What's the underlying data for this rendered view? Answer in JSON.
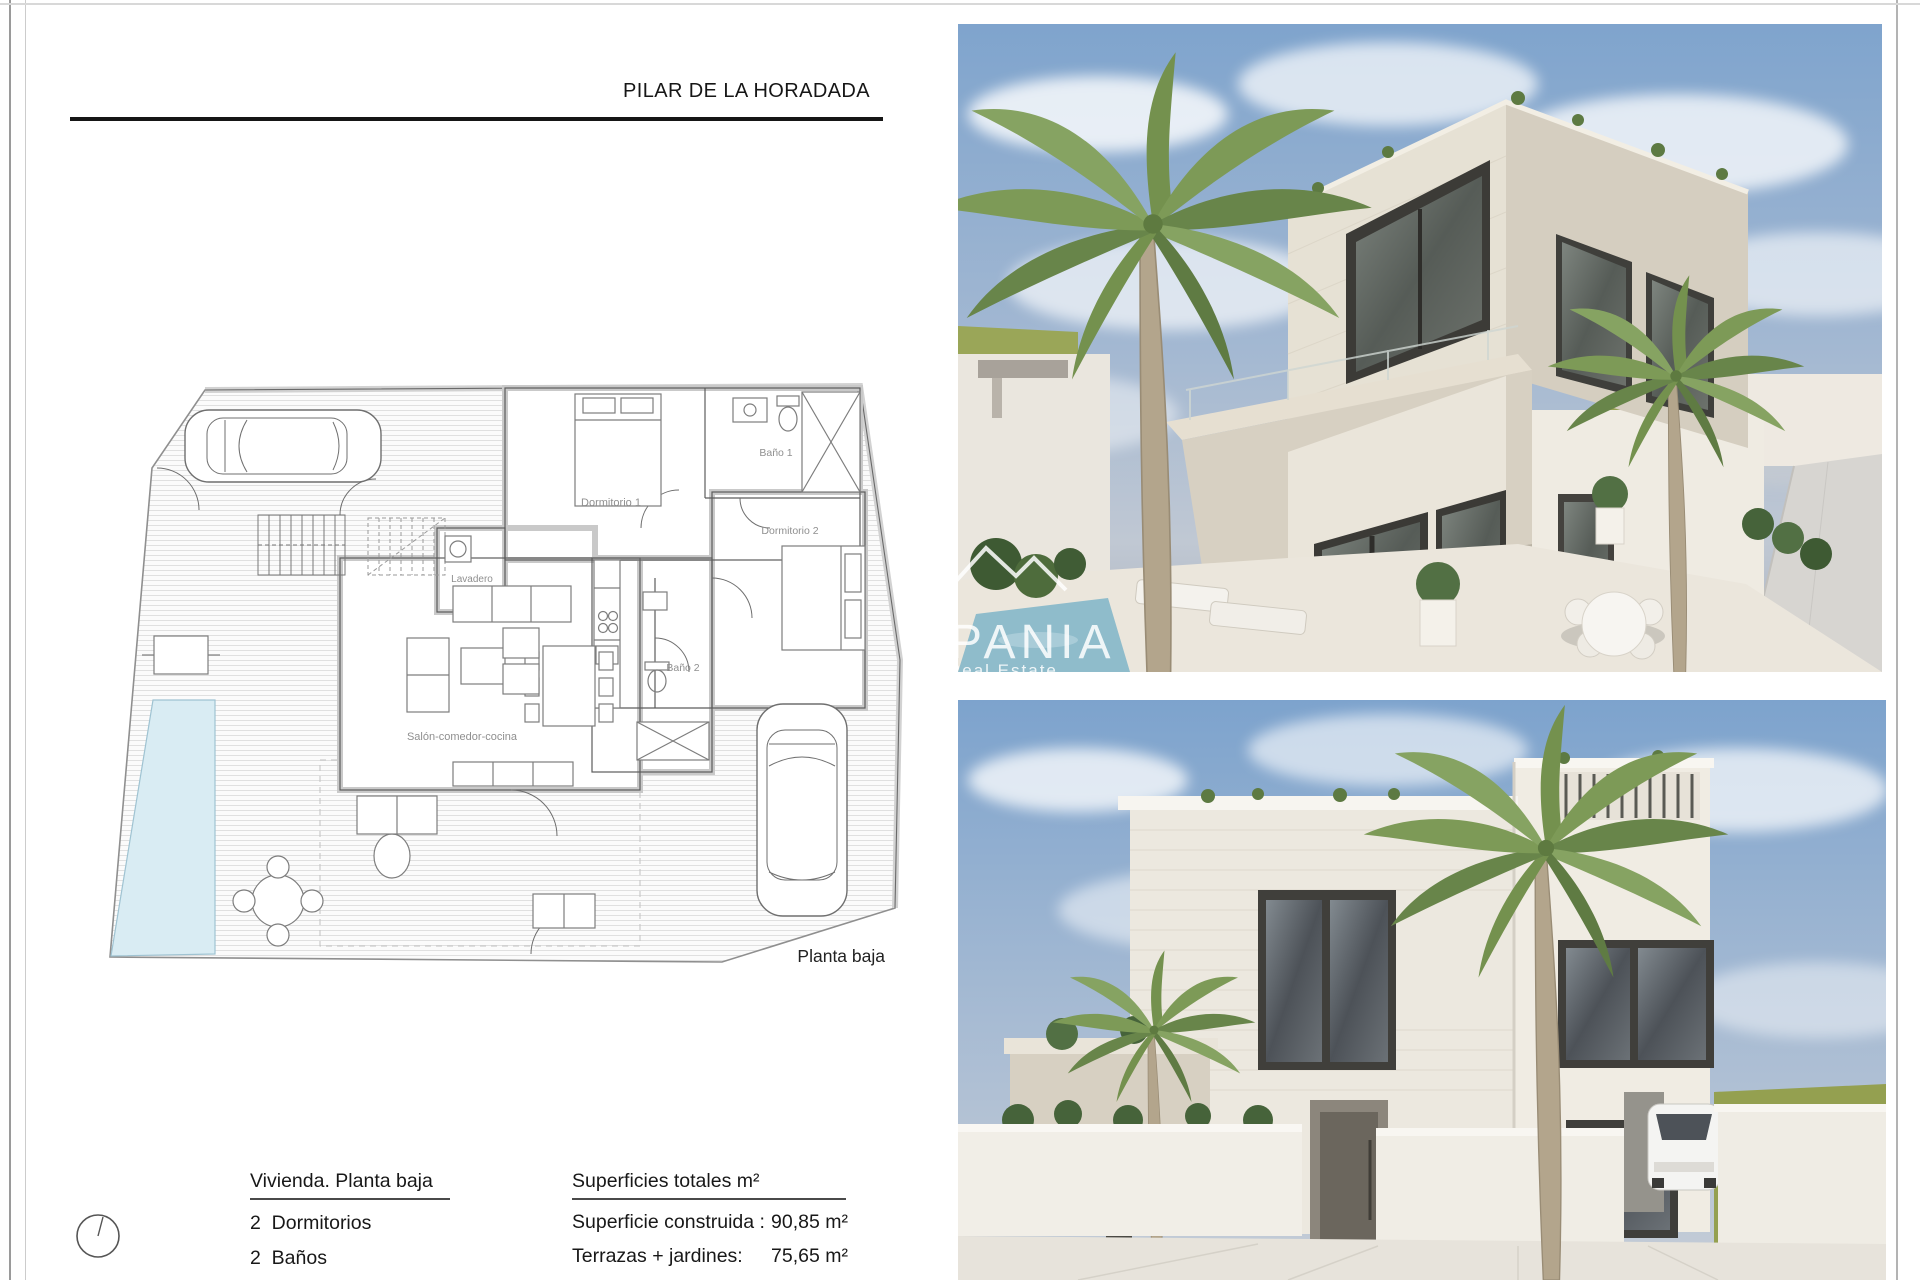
{
  "page": {
    "title": "PILAR DE LA HORADADA",
    "plan_caption": "Planta baja"
  },
  "floor_plan": {
    "rooms": [
      {
        "label": "Dormitorio 1"
      },
      {
        "label": "Baño 1"
      },
      {
        "label": "Dormitorio 2"
      },
      {
        "label": "Baño 2"
      },
      {
        "label": "Lavadero"
      },
      {
        "label": "Salón-comedor-cocina"
      }
    ]
  },
  "summary": {
    "dwelling_heading": "Vivienda. Planta baja",
    "dwelling_items": [
      {
        "text": "2  Dormitorios"
      },
      {
        "text": "2  Baños"
      }
    ],
    "areas_heading": "Superficies totales m²",
    "areas_rows": [
      {
        "label": "Superficie construida : ",
        "value": "90,85 m²"
      },
      {
        "label": "Terrazas + jardines:",
        "value": "75,65 m²"
      }
    ]
  },
  "renders": {
    "top_alt": "exterior-corner-view-render",
    "bottom_alt": "exterior-front-view-render",
    "watermark_brand": "PANIA",
    "watermark_tagline": "Real Estate"
  },
  "colors": {
    "pool": "#d9ecf3",
    "plan_wall": "#d2d2d2",
    "label_gray": "#8f8f8f",
    "sky_top": "#7fa4cd",
    "grass": "#97a254",
    "window_dark": "#3f3e3a"
  }
}
